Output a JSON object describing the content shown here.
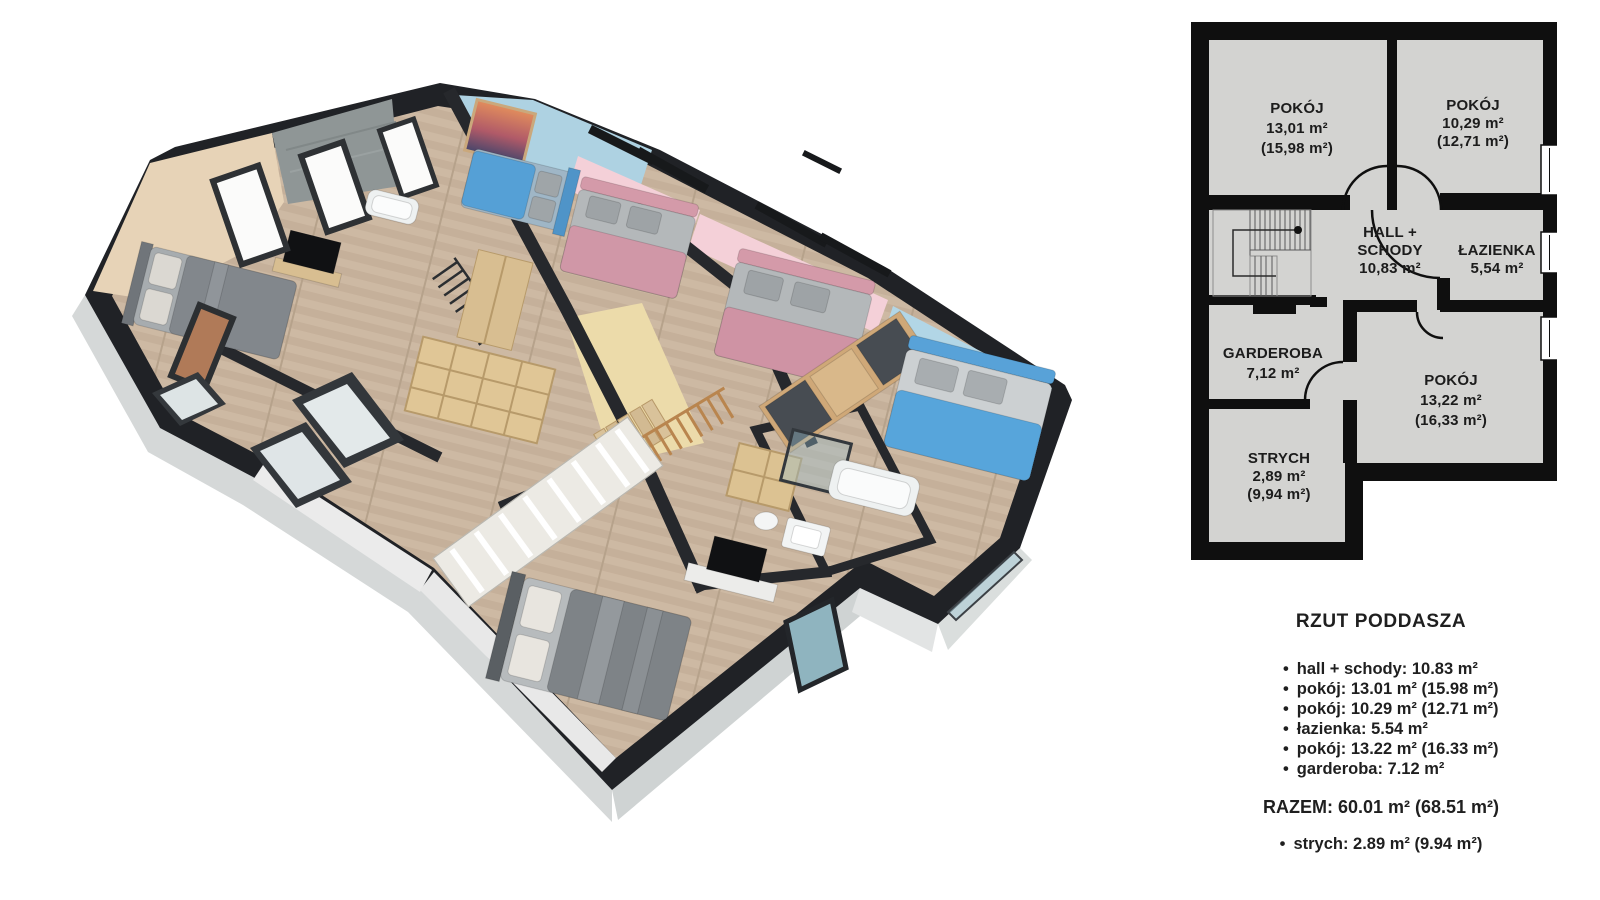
{
  "plan2d": {
    "rooms": [
      {
        "name": "POKÓJ",
        "area": "13,01 m²",
        "area_gross": "(15,98 m²)"
      },
      {
        "name": "POKÓJ",
        "area": "10,29 m²",
        "area_gross": "(12,71 m²)"
      },
      {
        "name_line1": "HALL +",
        "name_line2": "SCHODY",
        "area": "10,83 m²"
      },
      {
        "name": "ŁAZIENKA",
        "area": "5,54 m²"
      },
      {
        "name": "GARDEROBA",
        "area": "7,12 m²"
      },
      {
        "name": "POKÓJ",
        "area": "13,22 m²",
        "area_gross": "(16,33 m²)"
      },
      {
        "name": "STRYCH",
        "area": "2,89 m²",
        "area_gross": "(9,94 m²)"
      }
    ]
  },
  "legend": {
    "title": "RZUT PODDASZA",
    "items": [
      "hall + schody: 10.83 m²",
      "pokój: 13.01 m² (15.98 m²)",
      "pokój: 10.29 m² (12.71 m²)",
      "łazienka: 5.54 m²",
      "pokój: 13.22 m² (16.33 m²)",
      "garderoba: 7.12 m²"
    ],
    "total": "RAZEM: 60.01 m² (68.51 m²)",
    "attic_item": "strych: 2.89 m² (9.94 m²)"
  },
  "palette": {
    "plan_wall": "#0f0f0f",
    "plan_floor": "#d3d3d1",
    "render_wall_dark": "#202226",
    "render_floor_wood": "#cdb9a3",
    "wall_beige": "#e7d3b7",
    "wall_stone": "#8f9696",
    "wall_blue": "#aed2e2",
    "wall_pink": "#f4d0d8",
    "wall_yellow": "#ecdbaa",
    "bed_blue": "#58a0d4",
    "bed_pink": "#cf93a4",
    "exterior_gray": "#d5d8d8",
    "background": "#ffffff"
  }
}
